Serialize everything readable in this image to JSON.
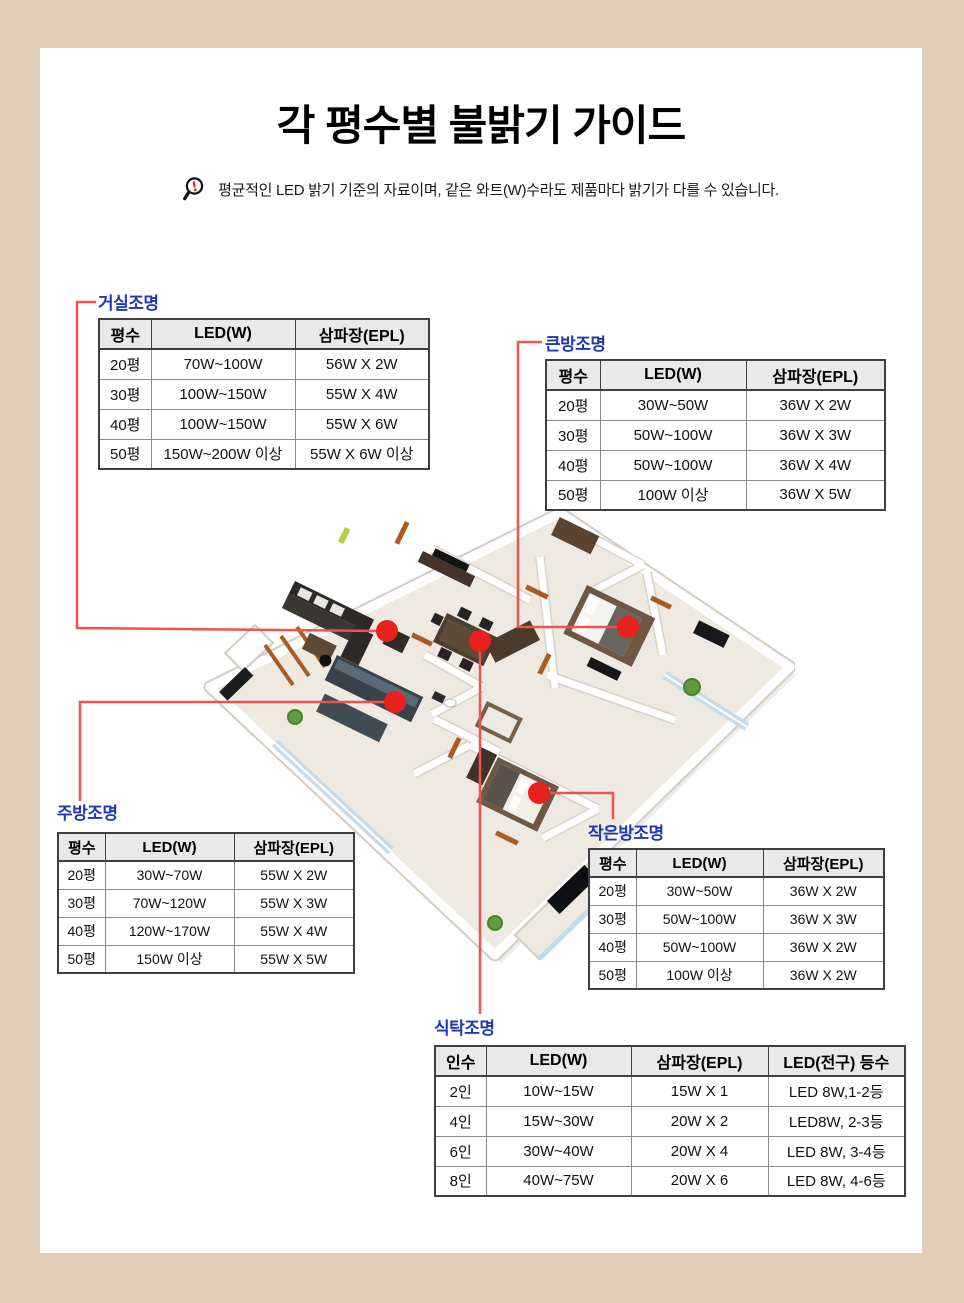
{
  "title": "각 평수별 불밝기 가이드",
  "notice": {
    "icon": "magnifier-alert-icon",
    "text": "평균적인 LED 밝기 기준의 자료이며, 같은 와트(W)수라도 제품마다 밝기가 다를 수 있습니다."
  },
  "colors": {
    "background": "#e1ccb8",
    "panel": "#ffffff",
    "label_blue": "#2038b0",
    "leader_red": "#f0534c",
    "dot_red": "#e8211d",
    "table_header_bg": "#e9e9e9",
    "table_border_dark": "#3f3f3f",
    "table_border_light": "#8c8c8c"
  },
  "tables": {
    "living": {
      "label": "거실조명",
      "headers": [
        "평수",
        "LED(W)",
        "삼파장(EPL)"
      ],
      "rows": [
        [
          "20평",
          "70W~100W",
          "56W X 2W"
        ],
        [
          "30평",
          "100W~150W",
          "55W X 4W"
        ],
        [
          "40평",
          "100W~150W",
          "55W X 6W"
        ],
        [
          "50평",
          "150W~200W 이상",
          "55W X 6W 이상"
        ]
      ]
    },
    "bigroom": {
      "label": "큰방조명",
      "headers": [
        "평수",
        "LED(W)",
        "삼파장(EPL)"
      ],
      "rows": [
        [
          "20평",
          "30W~50W",
          "36W X 2W"
        ],
        [
          "30평",
          "50W~100W",
          "36W X 3W"
        ],
        [
          "40평",
          "50W~100W",
          "36W X 4W"
        ],
        [
          "50평",
          "100W 이상",
          "36W X 5W"
        ]
      ]
    },
    "kitchen": {
      "label": "주방조명",
      "headers": [
        "평수",
        "LED(W)",
        "삼파장(EPL)"
      ],
      "rows": [
        [
          "20평",
          "30W~70W",
          "55W X 2W"
        ],
        [
          "30평",
          "70W~120W",
          "55W X 3W"
        ],
        [
          "40평",
          "120W~170W",
          "55W X 4W"
        ],
        [
          "50평",
          "150W 이상",
          "55W X 5W"
        ]
      ]
    },
    "smallroom": {
      "label": "작은방조명",
      "headers": [
        "평수",
        "LED(W)",
        "삼파장(EPL)"
      ],
      "rows": [
        [
          "20평",
          "30W~50W",
          "36W X 2W"
        ],
        [
          "30평",
          "50W~100W",
          "36W X 3W"
        ],
        [
          "40평",
          "50W~100W",
          "36W X 2W"
        ],
        [
          "50평",
          "100W 이상",
          "36W X 2W"
        ]
      ]
    },
    "dining": {
      "label": "식탁조명",
      "headers": [
        "인수",
        "LED(W)",
        "삼파장(EPL)",
        "LED(전구) 등수"
      ],
      "rows": [
        [
          "2인",
          "10W~15W",
          "15W X 1",
          "LED 8W,1-2등"
        ],
        [
          "4인",
          "15W~30W",
          "20W X 2",
          "LED8W, 2-3등"
        ],
        [
          "6인",
          "30W~40W",
          "20W X 4",
          "LED 8W, 3-4등"
        ],
        [
          "8인",
          "40W~75W",
          "20W X 6",
          "LED 8W, 4-6등"
        ]
      ]
    }
  },
  "callouts": [
    "거실조명",
    "큰방조명",
    "주방조명",
    "작은방조명",
    "식탁조명"
  ]
}
